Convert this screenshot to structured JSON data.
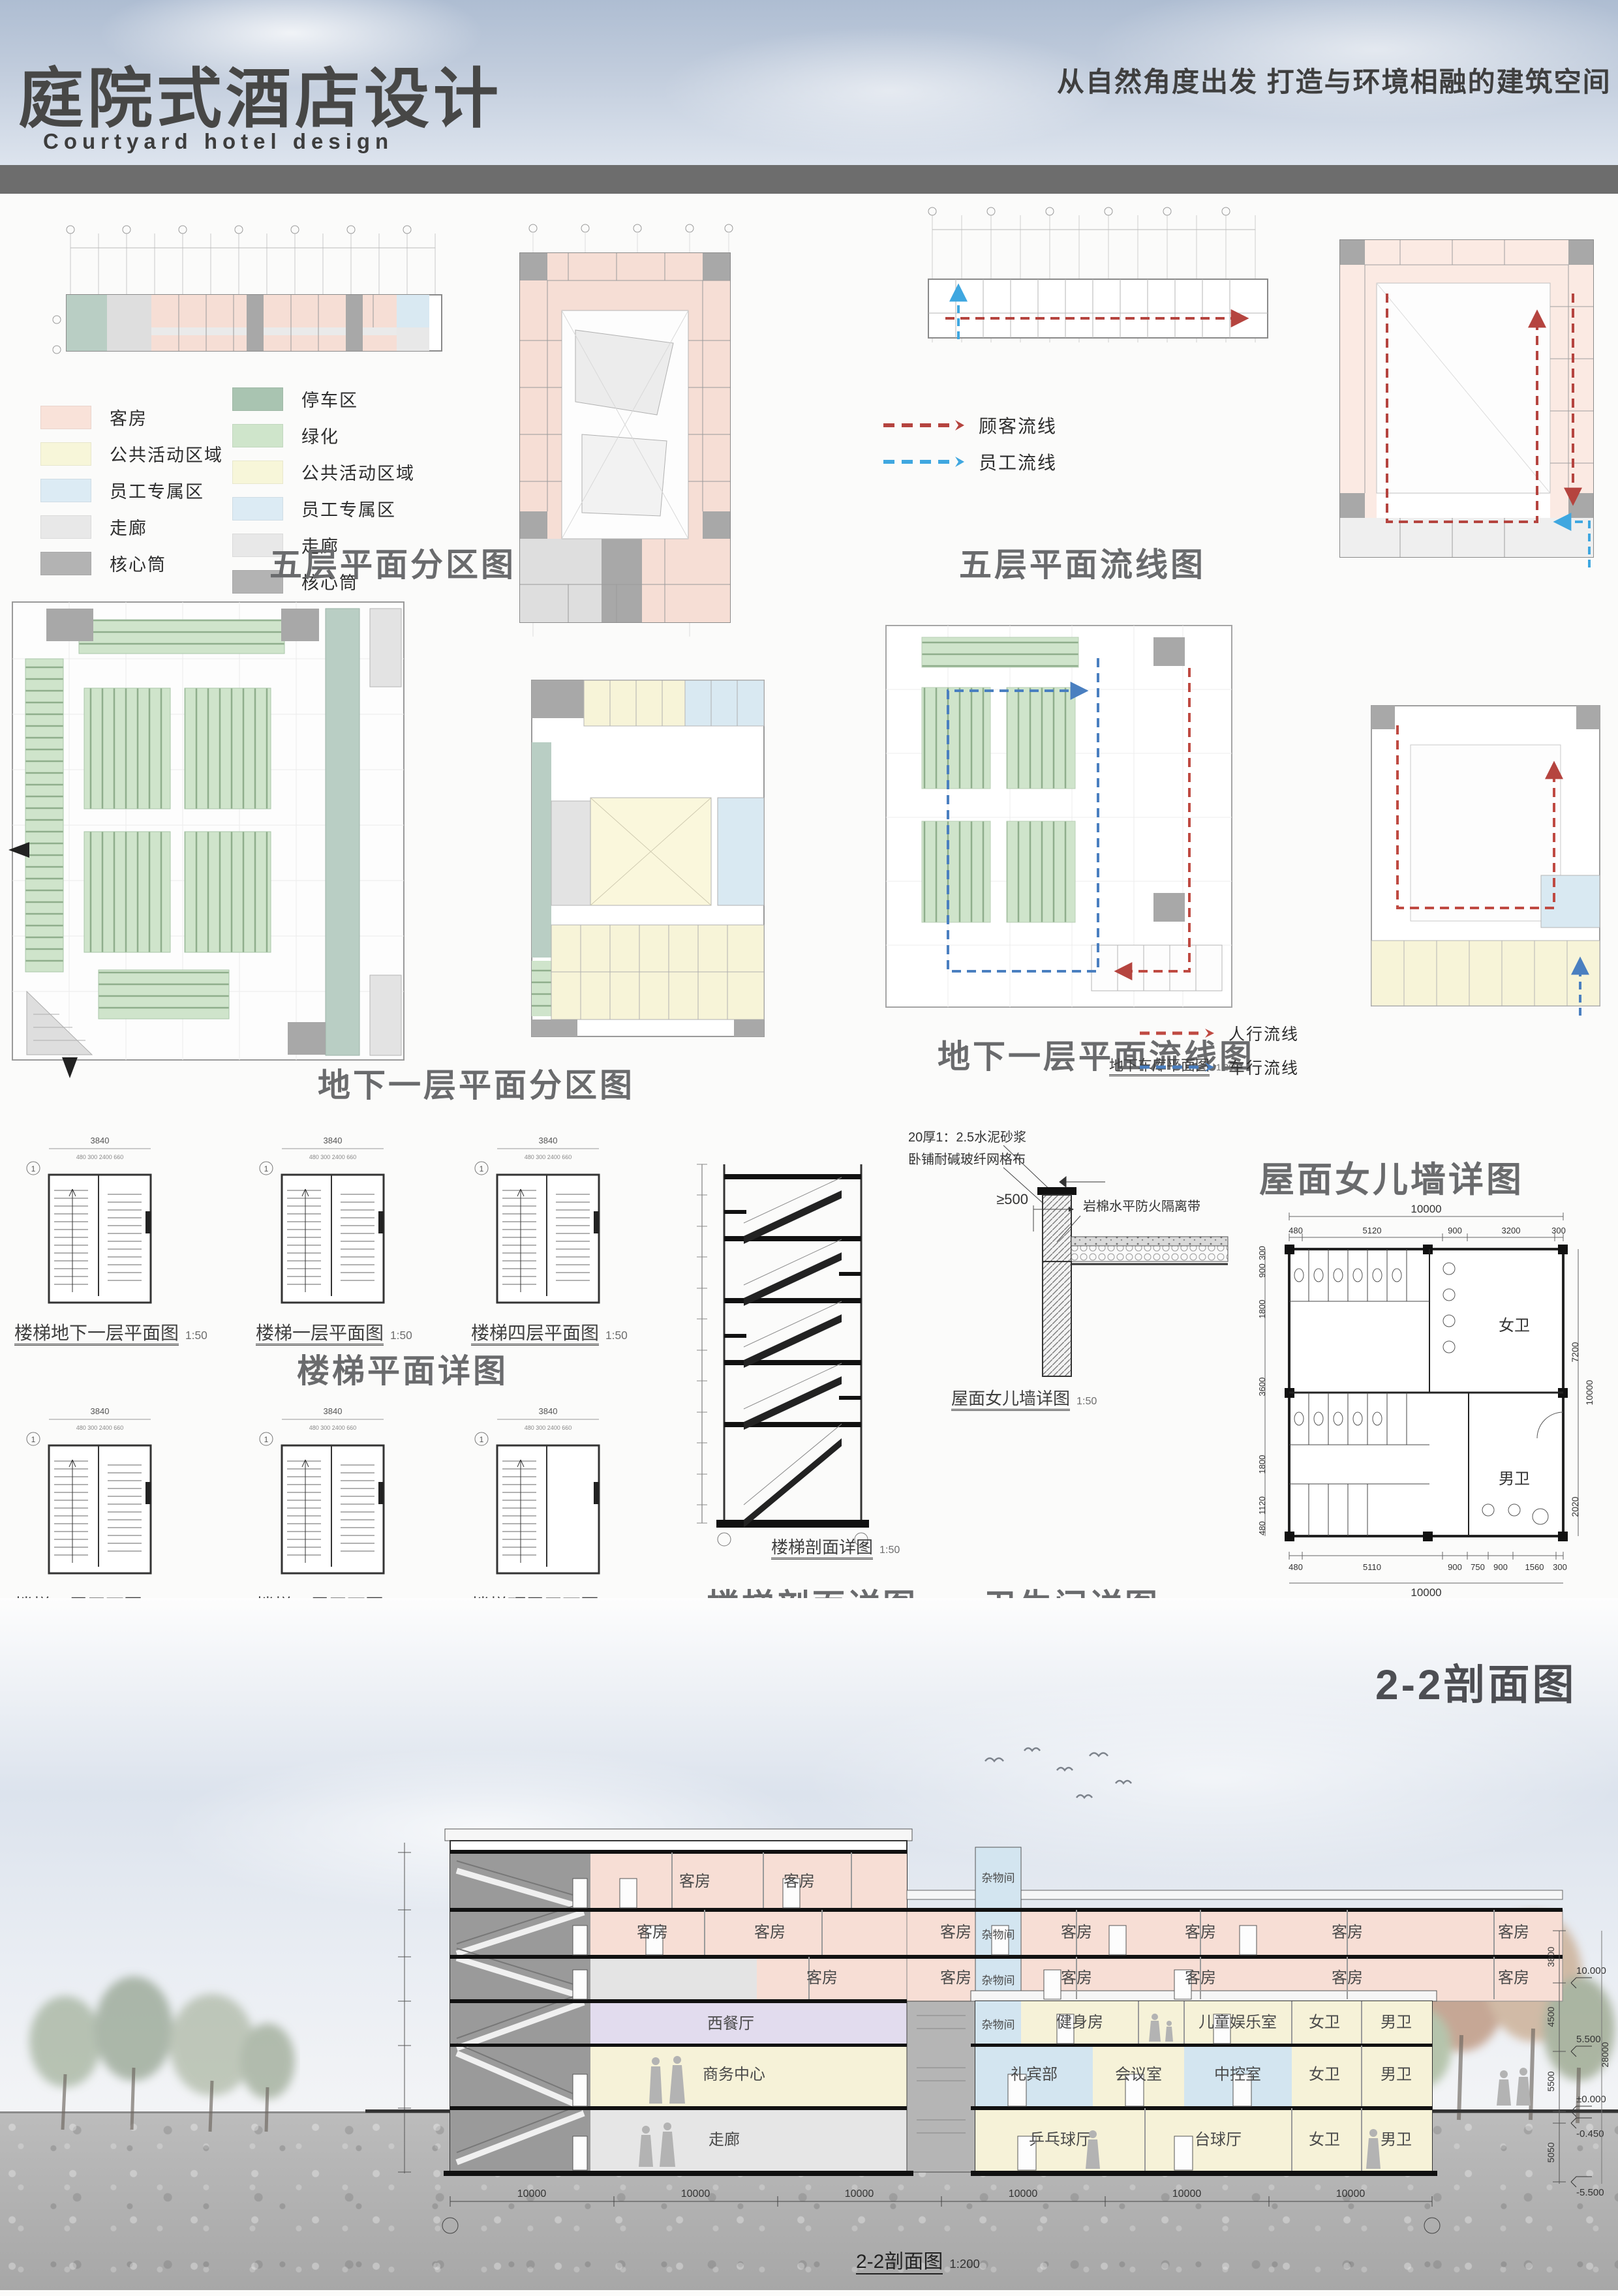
{
  "header": {
    "title": "庭院式酒店设计",
    "subtitle": "Courtyard hotel design",
    "tagline": "从自然角度出发 打造与环境相融的建筑空间"
  },
  "titles": {
    "floor5_zoning": "五层平面分区图",
    "floor5_flow": "五层平面流线图",
    "b1_zoning": "地下一层平面分区图",
    "b1_flow": "地下一层平面流线图",
    "b1_flow_caption": "地下车库平面图",
    "b1_flow_caption_scale": "1:200",
    "stair_plans": "楼梯平面详图",
    "stair_section": "楼梯剖面详图",
    "toilet": "卫生间详图",
    "parapet": "屋面女儿墙详图",
    "section": "2-2剖面图"
  },
  "legend_floor5": [
    {
      "label": "客房",
      "color": "#f9e2d9"
    },
    {
      "label": "公共活动区域",
      "color": "#f7f6d9"
    },
    {
      "label": "员工专属区",
      "color": "#dcebf4"
    },
    {
      "label": "走廊",
      "color": "#e8e8e8"
    },
    {
      "label": "核心筒",
      "color": "#b3b3b3"
    }
  ],
  "legend_b1": [
    {
      "label": "停车区",
      "color": "#a9c4b1"
    },
    {
      "label": "绿化",
      "color": "#cfe5cb"
    },
    {
      "label": "公共活动区域",
      "color": "#f7f6d9"
    },
    {
      "label": "员工专属区",
      "color": "#dcebf4"
    },
    {
      "label": "走廊",
      "color": "#e8e8e8"
    },
    {
      "label": "核心筒",
      "color": "#b3b3b3"
    }
  ],
  "flow_floor5": [
    {
      "label": "顾客流线",
      "color": "#b5443f"
    },
    {
      "label": "员工流线",
      "color": "#3fa7e0"
    }
  ],
  "flow_b1": [
    {
      "label": "人行流线",
      "color": "#bf4a42"
    },
    {
      "label": "车行流线",
      "color": "#4a7fc0"
    }
  ],
  "stair": {
    "grid": "1",
    "dim_total": "3840",
    "dim_parts": "480  300  2400  660",
    "captions": [
      {
        "label": "楼梯地下一层平面图",
        "scale": "1:50"
      },
      {
        "label": "楼梯一层平面图",
        "scale": "1:50"
      },
      {
        "label": "楼梯四层平面图",
        "scale": "1:50"
      },
      {
        "label": "楼梯二层平面图",
        "scale": "1:50"
      },
      {
        "label": "楼梯三层平面图",
        "scale": "1:50"
      },
      {
        "label": "楼梯顶层平面图",
        "scale": "1:50"
      }
    ],
    "section_caption": {
      "label": "楼梯剖面详图",
      "scale": "1:50"
    }
  },
  "parapet": {
    "note1": "20厚1：2.5水泥砂浆",
    "note2": "卧铺耐碱玻纤网格布",
    "note3": "岩棉水平防火隔离带",
    "dim": "≥500",
    "caption": "屋面女儿墙详图",
    "caption_scale": "1:50"
  },
  "toilet": {
    "top_total": "10000",
    "top": [
      "480",
      "5120",
      "900",
      "3200",
      "300"
    ],
    "bottom": [
      "480",
      "5110",
      "900",
      "750",
      "900",
      "1560",
      "300"
    ],
    "bottom_total": "10000",
    "left": [
      "300",
      "900",
      "1800",
      "3600",
      "1800",
      "1120",
      "480"
    ],
    "right": [
      "7200",
      "10000",
      "2020"
    ],
    "female": "女卫",
    "male": "男卫"
  },
  "section": {
    "caption": "2-2剖面图",
    "caption_scale": "1:200",
    "guest": "客房",
    "west_restaurant": "西餐厅",
    "business_center": "商务中心",
    "corridor": "走廊",
    "storage": "杂物间",
    "gym": "健身房",
    "kids_room": "儿童娱乐室",
    "concierge": "礼宾部",
    "meeting": "会议室",
    "control": "中控室",
    "pingpong": "乒乓球厅",
    "billiards": "台球厅",
    "female": "女卫",
    "male": "男卫",
    "levels": [
      "10.000",
      "5.500",
      "±0.000",
      "-0.450",
      "-5.500"
    ],
    "vdims": [
      "3800",
      "4500",
      "5500",
      "5050",
      "28000"
    ],
    "bay_dim": "10000"
  }
}
